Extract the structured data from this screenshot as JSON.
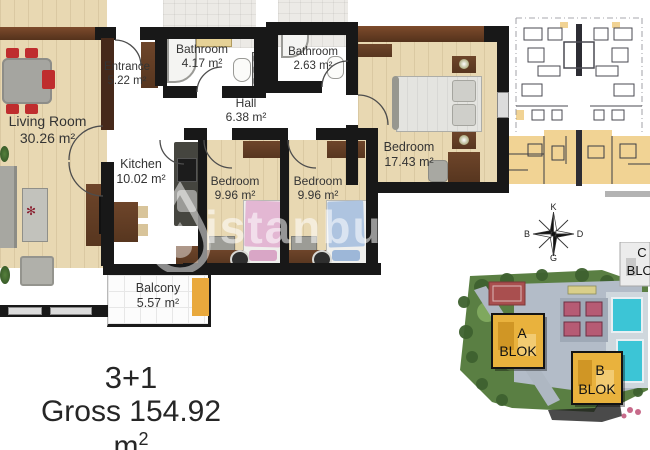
{
  "floorplan": {
    "rooms": {
      "living_room": {
        "name": "Living Room",
        "area": "30.26 m²"
      },
      "entrance": {
        "name": "Entrance",
        "area": "5.22 m²"
      },
      "bathroom_large": {
        "name": "Bathroom",
        "area": "4.17 m²"
      },
      "bathroom_small": {
        "name": "Bathroom",
        "area": "2.63 m²"
      },
      "hall": {
        "name": "Hall",
        "area": "6.38 m²"
      },
      "kitchen": {
        "name": "Kitchen",
        "area": "10.02 m²"
      },
      "bedroom_1": {
        "name": "Bedroom",
        "area": "9.96 m²"
      },
      "bedroom_2": {
        "name": "Bedroom",
        "area": "9.96 m²"
      },
      "bedroom_master": {
        "name": "Bedroom",
        "area": "17.43 m²"
      },
      "balcony": {
        "name": "Balcony",
        "area": "5.57 m²"
      }
    }
  },
  "summary": {
    "type_label": "3+1",
    "gross_prefix": "Gross 154.92 m",
    "gross_sup": "2"
  },
  "compass": {
    "north": "K",
    "east": "D",
    "south": "G",
    "west": "B"
  },
  "site_plan": {
    "blocks": [
      {
        "letter": "A",
        "word": "BLOK"
      },
      {
        "letter": "B",
        "word": "BLOK"
      },
      {
        "letter": "C",
        "word": "BLOK"
      }
    ]
  },
  "watermark": {
    "text": "istanbul"
  },
  "colors": {
    "wall": "#181818",
    "wood_floor": "#e8d8b2",
    "tile_floor": "#b6b6b3",
    "accent_orange": "#e9a93d",
    "keyplan_highlight": "#f1d394",
    "block_yellow": "#e9b23d",
    "pool_cyan": "#3cc5d6",
    "chair_red": "#bf2d2e"
  }
}
